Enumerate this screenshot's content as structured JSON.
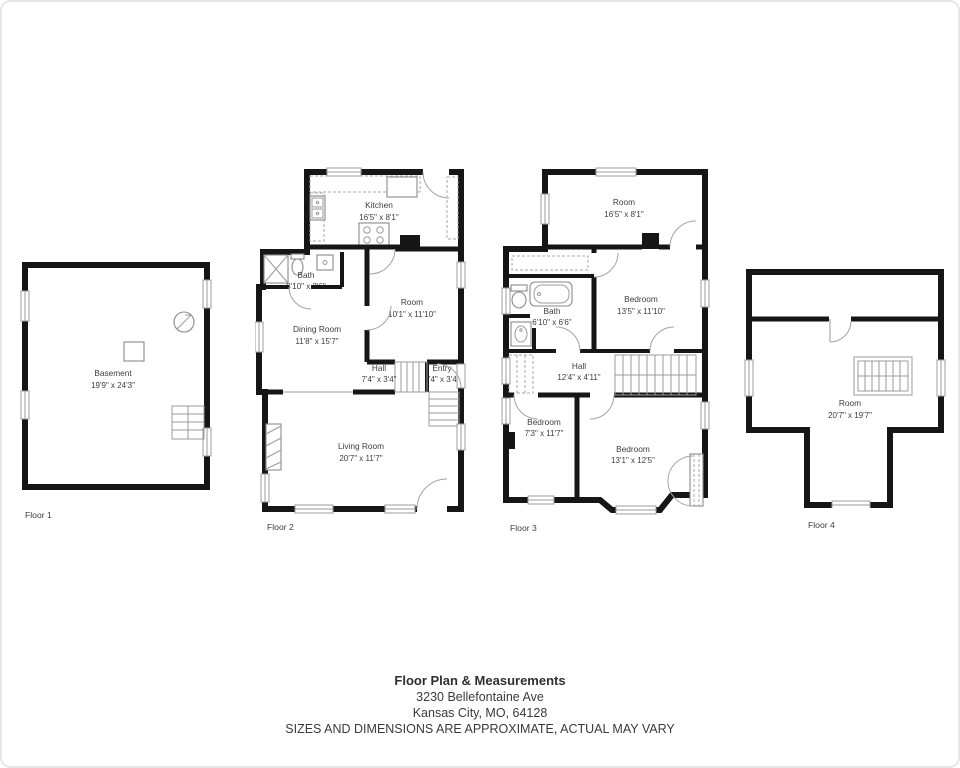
{
  "footer": {
    "title": "Floor Plan & Measurements",
    "address_line1": "3230 Bellefontaine Ave",
    "address_line2": "Kansas City, MO, 64128",
    "disclaimer": "SIZES AND DIMENSIONS ARE APPROXIMATE, ACTUAL MAY VARY"
  },
  "floors": [
    {
      "caption": "Floor 1",
      "rooms": [
        {
          "name": "Basement",
          "dims": "19'9\" x 24'3\""
        }
      ]
    },
    {
      "caption": "Floor 2",
      "rooms": [
        {
          "name": "Kitchen",
          "dims": "16'5\" x 8'1\""
        },
        {
          "name": "Bath",
          "dims": "8'10\" x 3'6\""
        },
        {
          "name": "Dining Room",
          "dims": "11'8\" x 15'7\""
        },
        {
          "name": "Room",
          "dims": "10'1\" x 11'10\""
        },
        {
          "name": "Hall",
          "dims": "7'4\" x 3'4\""
        },
        {
          "name": "Entry",
          "dims": "3'4\" x 3'4\""
        },
        {
          "name": "Living Room",
          "dims": "20'7\" x 11'7\""
        }
      ]
    },
    {
      "caption": "Floor 3",
      "rooms": [
        {
          "name": "Room",
          "dims": "16'5\" x 8'1\""
        },
        {
          "name": "Bedroom",
          "dims": "13'5\" x 11'10\""
        },
        {
          "name": "Bath",
          "dims": "6'10\" x 6'6\""
        },
        {
          "name": "Hall",
          "dims": "12'4\" x 4'11\""
        },
        {
          "name": "Bedroom",
          "dims": "7'3\" x 11'7\""
        },
        {
          "name": "Bedroom",
          "dims": "13'1\" x 12'5\""
        }
      ]
    },
    {
      "caption": "Floor 4",
      "rooms": [
        {
          "name": "Room",
          "dims": "20'7\" x 19'7\""
        }
      ]
    }
  ],
  "colors": {
    "wall": "#161616",
    "line": "#9b9b9b",
    "text": "#3d3d3d"
  }
}
